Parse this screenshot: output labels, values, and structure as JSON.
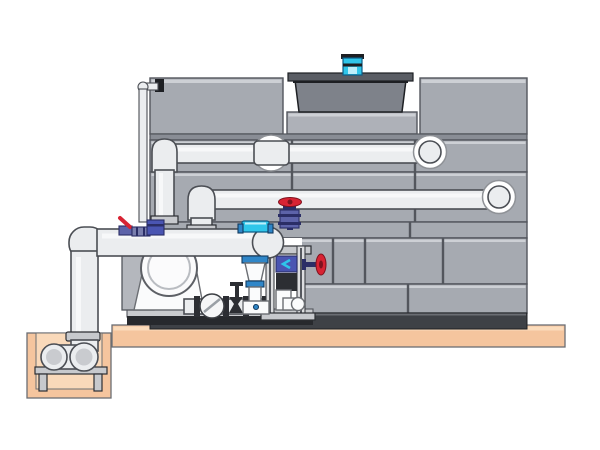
{
  "scene": {
    "type": "technical-illustration",
    "subject": "Closed-circuit cooling tower with external piping, pump skid, valve train and below-grade sump pit — side elevation, no text labels",
    "background": "#ffffff"
  },
  "colors": {
    "bg": "#ffffff",
    "panel": "#a6aab1",
    "panel_light": "#cdd0d5",
    "panel_shadow": "#898d95",
    "line": "#53565d",
    "structure_base": "#3e4146",
    "cowl": "#7e828a",
    "cowl_flange": "#5a5d64",
    "cowl_dark": "#1d1f23",
    "plinth": "#aeb1b8",
    "pipe": "#ebedef",
    "pipe_inner": "#c9cbcf",
    "pipe_outline": "#4b4e54",
    "ring_edge": "#8f9297",
    "steel": "#c7c9cd",
    "metal_dark": "#2c2e33",
    "white_part": "#fafbfc",
    "platform": "#f5c59e",
    "platform_light": "#fbdcbc",
    "pit_inner": "#f9d9ba",
    "equip_pad": "#c9cbce",
    "equip_dark": "#27292d",
    "red": "#d82333",
    "red_dark": "#7e121e",
    "purple": "#5d63a9",
    "purple_dark": "#2b2e66",
    "blue": "#2f86c8",
    "cyan": "#2fc6ea",
    "cyan_light": "#bdeffb",
    "pump_blue": "#4a55b2"
  },
  "parts": [
    "cooling-tower-casing",
    "fan-cowl",
    "fan-motor",
    "tower-plinth",
    "upper-return-pipe",
    "middle-return-pipe",
    "main-suction-pipe",
    "make-up-water-pipe",
    "pump-volute",
    "pump-suction-duct",
    "basket-strainer",
    "gate-valve",
    "globe-valve-red-handwheel",
    "ball-valve-red-lever",
    "dosing-pump",
    "clamp-on-sensor",
    "injection-cone",
    "instrument-frame",
    "side-globe-valve",
    "bottom-run-piping",
    "equipment-skid-base",
    "concrete-platform",
    "sump-pit",
    "sump-suction-elbow",
    "pipe-support-stand"
  ]
}
